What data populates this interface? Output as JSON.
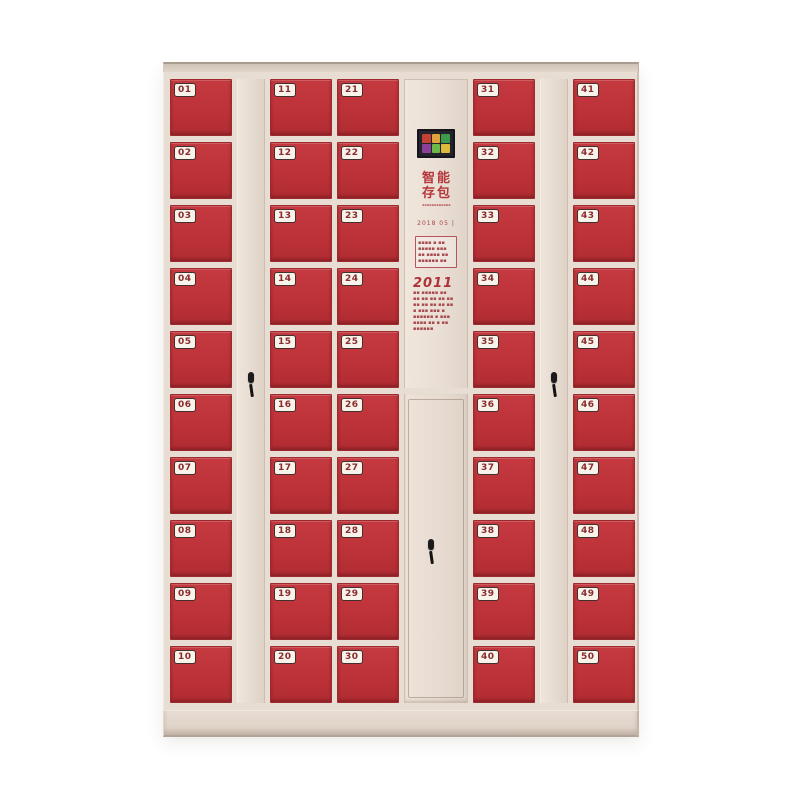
{
  "meta": {
    "title": "Beige electronic storage locker cabinet with 50 red numbered doors",
    "background": "#ffffff"
  },
  "colors": {
    "door_red": "#bf3338",
    "door_red_dark": "#9c2a2f",
    "frame_beige": "#e8ddd3",
    "strip_beige": "#e5dacf",
    "panel_beige": "#ece1d7",
    "badge_bg": "#f7f2ea",
    "badge_text": "#8a2b2e",
    "lock_black": "#1b1b1b",
    "screen_bg": "#23232b",
    "accent_text_red": "#b03136"
  },
  "cabinet": {
    "rows_per_column": 10,
    "total_lockers": 50,
    "columns": [
      {
        "type": "doors",
        "name": "door-column-1",
        "numbers": [
          "01",
          "02",
          "03",
          "04",
          "05",
          "06",
          "07",
          "08",
          "09",
          "10"
        ]
      },
      {
        "type": "strip",
        "name": "divider-left",
        "has_lock": true
      },
      {
        "type": "doors",
        "name": "door-column-2",
        "numbers": [
          "11",
          "12",
          "13",
          "14",
          "15",
          "16",
          "17",
          "18",
          "19",
          "20"
        ]
      },
      {
        "type": "doors",
        "name": "door-column-3",
        "numbers": [
          "21",
          "22",
          "23",
          "24",
          "25",
          "26",
          "27",
          "28",
          "29",
          "30"
        ]
      },
      {
        "type": "panel",
        "name": "center-column"
      },
      {
        "type": "doors",
        "name": "door-column-4",
        "numbers": [
          "31",
          "32",
          "33",
          "34",
          "35",
          "36",
          "37",
          "38",
          "39",
          "40"
        ]
      },
      {
        "type": "strip",
        "name": "divider-right",
        "has_lock": true
      },
      {
        "type": "doors",
        "name": "door-column-5",
        "numbers": [
          "41",
          "42",
          "43",
          "44",
          "45",
          "46",
          "47",
          "48",
          "49",
          "50"
        ]
      }
    ],
    "panel": {
      "screen": {
        "label": "color-display",
        "pixels": [
          "#c44032",
          "#e0a23a",
          "#3e9a4b",
          "#8a3f9b",
          "#6cb84a",
          "#ddb93c"
        ]
      },
      "logo": {
        "chars": [
          "智",
          "能",
          "存",
          "包"
        ],
        "caption": "▪▪▪▪▪▪▪▪▪▪▪▪"
      },
      "date_text": "2018 05 |",
      "notice_box_lines": [
        "▪▪▪▪ ▪ ▪▪",
        "▪▪▪▪▪ ▪▪▪",
        "▪▪ ▪▪▪▪ ▪▪",
        "▪▪▪▪▪▪ ▪▪"
      ],
      "calendar": {
        "title": "2011",
        "lines": [
          "▪▪ ▪▪▪▪▪ ▪▪",
          "▪▪ ▪▪ ▪▪ ▪▪ ▪▪",
          "▪▪ ▪▪ ▪▪ ▪▪ ▪▪",
          "▪ ▪▪▪ ▪▪▪ ▪",
          "▪▪▪▪▪▪ ▪ ▪▪▪",
          "▪▪▪▪ ▪▪ ▪ ▪▪",
          "▪▪▪▪▪▪"
        ]
      }
    }
  }
}
